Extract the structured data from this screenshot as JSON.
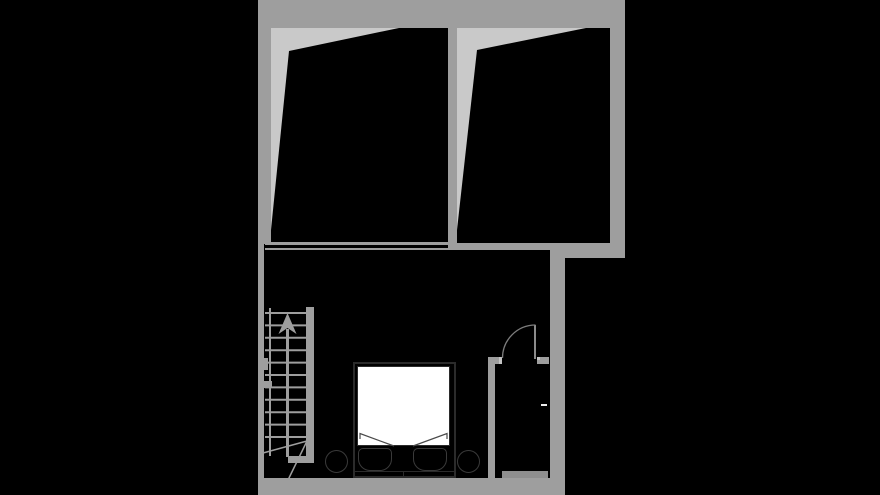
{
  "colors": {
    "background": "#000000",
    "wall": "#9e9e9e",
    "attic_bg": "#c9c9c9",
    "wall_light": "#c4c4c4",
    "threshold": "#8e8e8e",
    "furniture_line": "#2b2b2b",
    "furniture_line_soft": "#3a3a3a",
    "duvet": "#ffffff",
    "door_line": "#8b8b8b",
    "arc_line": "#7d7d7d",
    "tick_white": "#ededed"
  },
  "plan": {
    "type": "floor-plan",
    "text": [],
    "rooms": [
      {
        "name": "attic-room-left",
        "style": "sloped-ceiling"
      },
      {
        "name": "attic-room-right",
        "style": "sloped-ceiling"
      },
      {
        "name": "bedroom"
      },
      {
        "name": "closet"
      }
    ],
    "features": [
      "staircase-with-up-arrow",
      "winder-steps",
      "double-bed-with-two-pillows",
      "two-round-stools",
      "door-with-quarter-swing-arc",
      "knee-wall-double-line"
    ]
  }
}
